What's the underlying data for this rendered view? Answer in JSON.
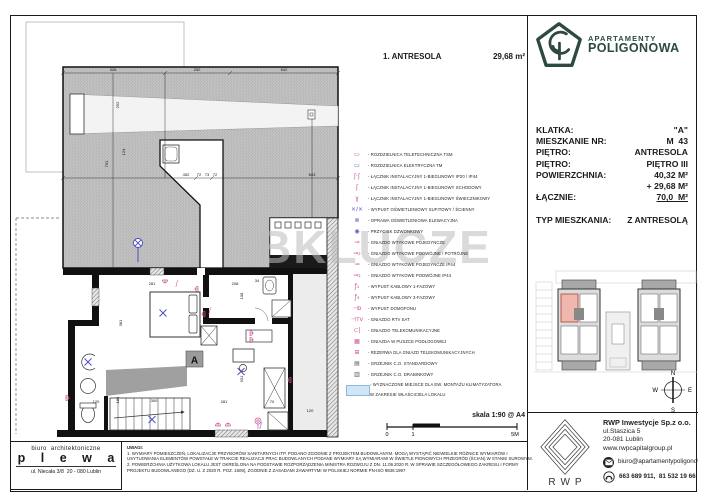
{
  "header": {
    "plan_label": "1. ANTRESOLA",
    "plan_area": "29,68 m²"
  },
  "brand": {
    "line1": "APARTAMENTY",
    "line2": "POLIGONOWA",
    "color": "#2d4a42"
  },
  "watermark": "BKLUCZE",
  "info": {
    "rows": [
      {
        "label": "KLATKA:",
        "value": "\"A\""
      },
      {
        "label": "MIESZKANIE NR:",
        "value": "M  43"
      },
      {
        "label": "PIĘTRO:",
        "value": "ANTRESOLA"
      },
      {
        "label": "PIĘTRO:",
        "value": "PIĘTRO III"
      },
      {
        "label": "POWIERZCHNIA:",
        "value": "40,32 M²"
      },
      {
        "label": "",
        "value": "+ 29,68 M²"
      },
      {
        "label": "ŁĄCZNIE:",
        "value": "70,0  M²",
        "cls": "total"
      }
    ],
    "type_label": "TYP MIESZKANIA:",
    "type_value": "Z ANTRESOLĄ"
  },
  "legend": {
    "items": [
      {
        "glyph": "▭",
        "cls": "pink",
        "label": "- ROZDZIELNICA TELETECHNICZNA TSM"
      },
      {
        "glyph": "▭",
        "cls": "blue",
        "label": "- ROZDZIELNICA ELEKTRYCZNA TM"
      },
      {
        "glyph": "ʃ·ʃ",
        "cls": "pink",
        "label": "- ŁĄCZNIK INSTALACYJNY 1-BIEGUNOWY IP20 / IP44"
      },
      {
        "glyph": "ʃ",
        "cls": "pink",
        "label": "- ŁĄCZNIK INSTALACYJNY 1-BIEGUNOWY SCHODOWY"
      },
      {
        "glyph": "ɣ",
        "cls": "pink",
        "label": "- ŁĄCZNIK INSTALACYJNY 1-BIEGUNOWY ŚWIECZNIKOWY"
      },
      {
        "glyph": "×∕×",
        "cls": "blue",
        "label": "- WYPUST OŚWIETLENIOWY SUFITOWY / ŚCIENNY"
      },
      {
        "glyph": "⊗",
        "cls": "blue",
        "label": "- OPRAWA OŚWIETLENIOWA ELEWACYJNA"
      },
      {
        "glyph": "◉",
        "cls": "blue",
        "label": "- PRZYCISK DZWONKOWY"
      },
      {
        "glyph": "⊸",
        "cls": "pink",
        "label": "- GNIAZDO WTYKOWE POJEDYNCZE"
      },
      {
        "glyph": "⊸₂",
        "cls": "pink",
        "label": "- GNIAZDO WTYKOWE PODWÓJNE / POTRÓJNE"
      },
      {
        "glyph": "⊸",
        "cls": "pink",
        "label": "- GNIAZDO WTYKOWE POJEDYNCZE IP44"
      },
      {
        "glyph": "⊸₂",
        "cls": "pink",
        "label": "- GNIAZDO WTYKOWE PODWÓJNE IP44"
      },
      {
        "glyph": "ƒ₁",
        "cls": "pink",
        "label": "- WYPUST KABLOWY 1-FAZOWY"
      },
      {
        "glyph": "ƒ₃",
        "cls": "pink",
        "label": "- WYPUST KABLOWY 3-FAZOWY"
      },
      {
        "glyph": "⊣ᴅ",
        "cls": "pink",
        "label": "- WYPUST DOMOFONU"
      },
      {
        "glyph": "⊣ᴛᴠ",
        "cls": "pink",
        "label": "- GNIAZDO RTV SAT"
      },
      {
        "glyph": "⊂|",
        "cls": "pink",
        "label": "- GNIAZDO TELEKOMUNIKACYJNE"
      },
      {
        "glyph": "▦",
        "cls": "pink",
        "label": "- GNIAZDA W PUSZCE PODŁOGOWEJ"
      },
      {
        "glyph": "⊞",
        "cls": "pink",
        "label": "- REZERWA DLA GNIAZD TELEKOMUNIKACYJNYCH"
      },
      {
        "glyph": "▤",
        "cls": "dark",
        "label": "- GRZEJNIK C.O. STANDARDOWY"
      },
      {
        "glyph": "▥",
        "cls": "dark",
        "label": "- GRZEJNIK C.O. DRABINKOWY"
      },
      {
        "glyph": "",
        "cls": "acbox",
        "label": "- WYZNACZONE MIEJSCE DLA EW. MONTAŻU KLIMATYZATORA\nW ZAKRESIE WŁAŚCICIELA LOKALU"
      }
    ]
  },
  "plan": {
    "marker": "A",
    "dims": [
      {
        "x": 113,
        "y": 71,
        "t": "326"
      },
      {
        "x": 197,
        "y": 71,
        "t": "252"
      },
      {
        "x": 284,
        "y": 71,
        "t": "642"
      },
      {
        "x": 186,
        "y": 176,
        "t": "452"
      },
      {
        "x": 199,
        "y": 176,
        "t": "72"
      },
      {
        "x": 207,
        "y": 176,
        "t": "73"
      },
      {
        "x": 215,
        "y": 176,
        "t": "72"
      },
      {
        "x": 312,
        "y": 176,
        "t": "643"
      },
      {
        "x": 119,
        "y": 105,
        "t": "252",
        "r": 1
      },
      {
        "x": 125,
        "y": 152,
        "t": "124",
        "r": 1
      },
      {
        "x": 108,
        "y": 164,
        "t": "791",
        "r": 1
      },
      {
        "x": 152,
        "y": 285,
        "t": "281"
      },
      {
        "x": 235,
        "y": 285,
        "t": "208"
      },
      {
        "x": 257,
        "y": 282,
        "t": "34"
      },
      {
        "x": 243,
        "y": 296,
        "t": "108",
        "r": 1
      },
      {
        "x": 122,
        "y": 323,
        "t": "381",
        "r": 1
      },
      {
        "x": 243,
        "y": 379,
        "t": "331",
        "r": 1
      },
      {
        "x": 154,
        "y": 402,
        "t": "300"
      },
      {
        "x": 119,
        "y": 400,
        "t": "185",
        "r": 1
      },
      {
        "x": 96,
        "y": 403,
        "t": "120"
      },
      {
        "x": 224,
        "y": 403,
        "t": "281"
      },
      {
        "x": 272,
        "y": 403,
        "t": "70"
      },
      {
        "x": 310,
        "y": 412,
        "t": "120"
      }
    ]
  },
  "scale": {
    "label": "skala 1:90 @ A4",
    "tick0": "0",
    "tick1": "1",
    "tick5": "5M"
  },
  "compass": {
    "n": "N",
    "e": "E",
    "s": "S",
    "w": "W"
  },
  "notes": {
    "title": "UWAGI:",
    "lines": [
      "1. WYMIARY POMIESZCZEŃ, LOKALIZACJE PRZYBORÓW SANITARNYCH ITP. PODANO ZGODNIE Z PROJEKTEM BUDOWLANYM. MOGĄ WYSTĄPIĆ NIEWIELKIE RÓŻNICE WYMIARÓW I",
      "USYTUOWANIA ELEMENTÓW POWSTAŁE W TRAKCIE REALIZACJI PRAC BUDOWLANYCH PODANE WYMIARY SĄ WYMIARAMI W ŚWIETLE PIONOWYCH PRZEGRÓD (ŚCIAN) W STANIE SUROWYM.",
      "2. POWIERZCHNIA UŻYTKOWA LOKALU JEST OKREŚLONA NA PODSTAWIE ROZPORZĄDZENIA MINISTRA ROZWOJU Z DN. 11.09.2020 R. W SPRAWIE SZCZEGÓŁOWEGO ZAKRESU I FORMY",
      "PROJEKTU BUDOWLANEGO (DZ. U. Z 2020 R. POZ. 1609), ZGODNIE Z ZASADAMI ZAWARTYMI W POLSKIEJ NORMIE PN-ISO 9836:1997"
    ]
  },
  "architect": {
    "line1": "biuro  architektoniczne",
    "name": "p l e w a",
    "address": "ul. Niecała 3/8  20 - 080 Lublin"
  },
  "developer": {
    "logo_text": "RWP",
    "company": "RWP Inwestycje Sp.z o.o.",
    "address1": "ul.Staszica 5",
    "address2": "20-081 Lublin",
    "website": "www.rwpcapitalgroup.pl",
    "email": "biuro@apartamentypoligonowa.pl",
    "phone": "663 689 911,  81 532 19 66"
  }
}
